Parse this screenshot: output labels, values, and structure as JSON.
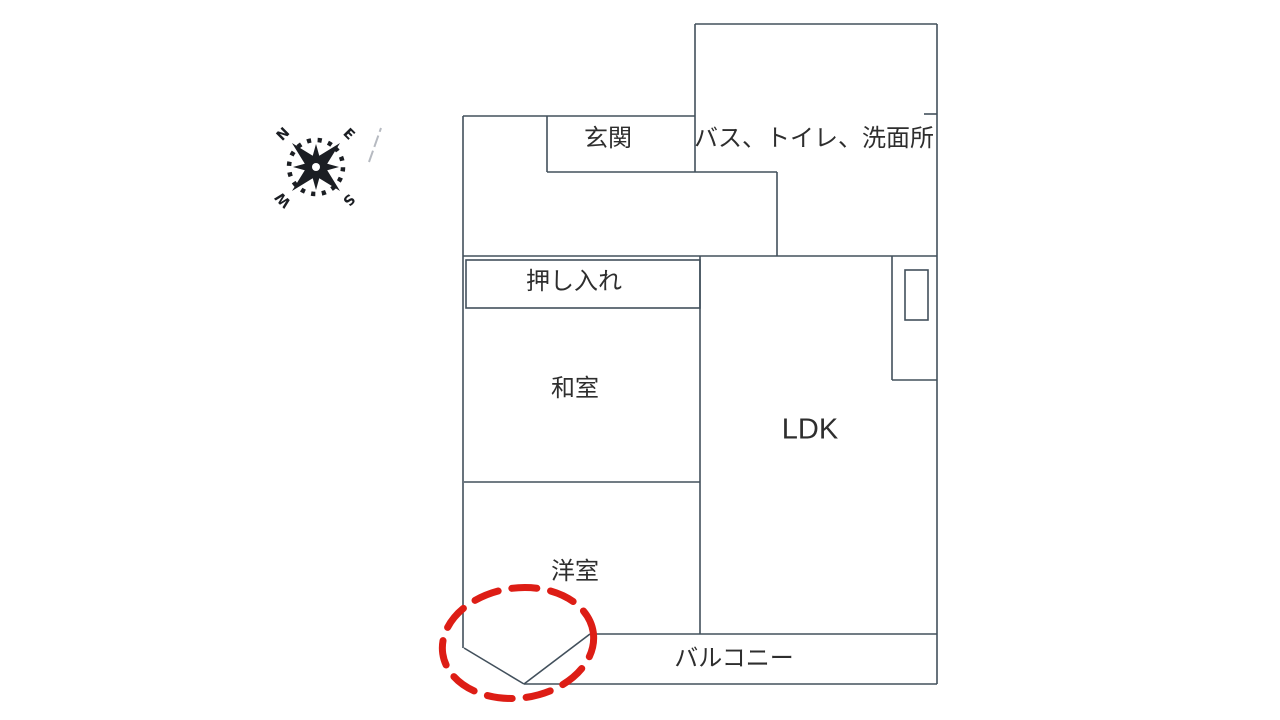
{
  "colors": {
    "background": "#ffffff",
    "wall": "#42505c",
    "text": "#2e2e2e",
    "annotation_red": "#dd1d15",
    "compass": "#1b1e23",
    "pencil": "#a9aeb6"
  },
  "compass": {
    "letters": {
      "north": "N",
      "east": "E",
      "south": "S",
      "west": "W"
    },
    "center_x": 316,
    "center_y": 167,
    "rotation_deg": -45
  },
  "rooms": [
    {
      "id": "genkan",
      "label": "玄関",
      "x": 608,
      "y": 139,
      "size": 24
    },
    {
      "id": "bathroom",
      "label": "バス、トイレ、洗面所",
      "x": 814,
      "y": 139,
      "size": 24
    },
    {
      "id": "oshiire",
      "label": "押し入れ",
      "x": 574,
      "y": 282,
      "size": 24
    },
    {
      "id": "washitsu",
      "label": "和室",
      "x": 575,
      "y": 389,
      "size": 24
    },
    {
      "id": "ldk",
      "label": "LDK",
      "x": 810,
      "y": 430,
      "size": 29
    },
    {
      "id": "yoshitsu",
      "label": "洋室",
      "x": 575,
      "y": 572,
      "size": 24
    },
    {
      "id": "balcony",
      "label": "バルコニー",
      "x": 734,
      "y": 659,
      "size": 24
    }
  ],
  "floorplan": {
    "segments": [
      [
        463,
        116,
        695,
        116
      ],
      [
        463,
        116,
        463,
        648
      ],
      [
        695,
        24,
        937,
        24
      ],
      [
        695,
        24,
        695,
        172
      ],
      [
        937,
        24,
        937,
        684
      ],
      [
        547,
        116,
        547,
        172
      ],
      [
        547,
        172,
        777,
        172
      ],
      [
        777,
        172,
        777,
        256
      ],
      [
        463,
        256,
        937,
        256
      ],
      [
        700,
        256,
        700,
        634
      ],
      [
        464,
        482,
        700,
        482
      ],
      [
        892,
        256,
        892,
        380
      ],
      [
        892,
        380,
        937,
        380
      ],
      [
        590,
        634,
        937,
        634
      ],
      [
        524,
        684,
        937,
        684
      ],
      [
        464,
        648,
        524,
        684
      ],
      [
        524,
        684,
        590,
        634
      ],
      [
        924,
        114,
        937,
        114
      ]
    ],
    "rects": [
      [
        466,
        260,
        234,
        48
      ],
      [
        905,
        270,
        23,
        50
      ]
    ]
  },
  "annotation": {
    "ellipse": {
      "cx": 518,
      "cy": 643,
      "rx": 76,
      "ry": 55,
      "rotation": -8
    }
  }
}
